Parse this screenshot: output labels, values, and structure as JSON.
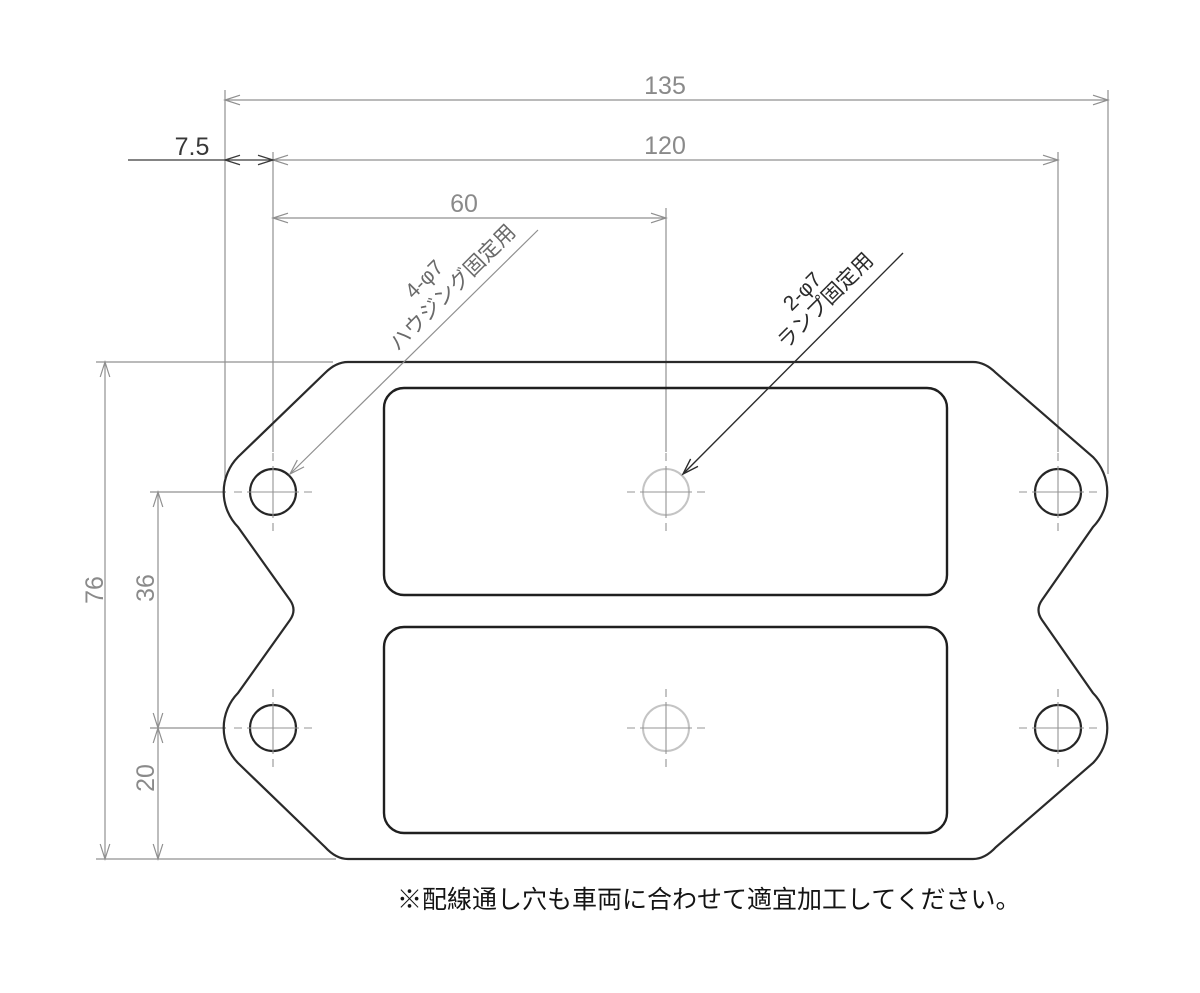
{
  "drawing": {
    "dims": {
      "overall_width": "135",
      "hole_span_width": "120",
      "center_hole_offset": "60",
      "edge_to_first_hole": "7.5",
      "overall_height": "76",
      "hole_row_spacing": "36",
      "bottom_hole_offset": "20"
    },
    "callouts": {
      "housing": {
        "qty": "4-φ7",
        "use": "ハウジング固定用"
      },
      "lamp": {
        "qty": "2-φ7",
        "use": "ランプ固定用"
      }
    },
    "note": "※配線通し穴も車両に合わせて適宜加工してください。",
    "colors": {
      "outline_ink": "#2a2a2a",
      "dimension_gray": "#8a8a8a",
      "edge_dim_dark": "#383838",
      "lamp_hole_light": "#c4c4c4",
      "note_ink": "#141414"
    }
  }
}
